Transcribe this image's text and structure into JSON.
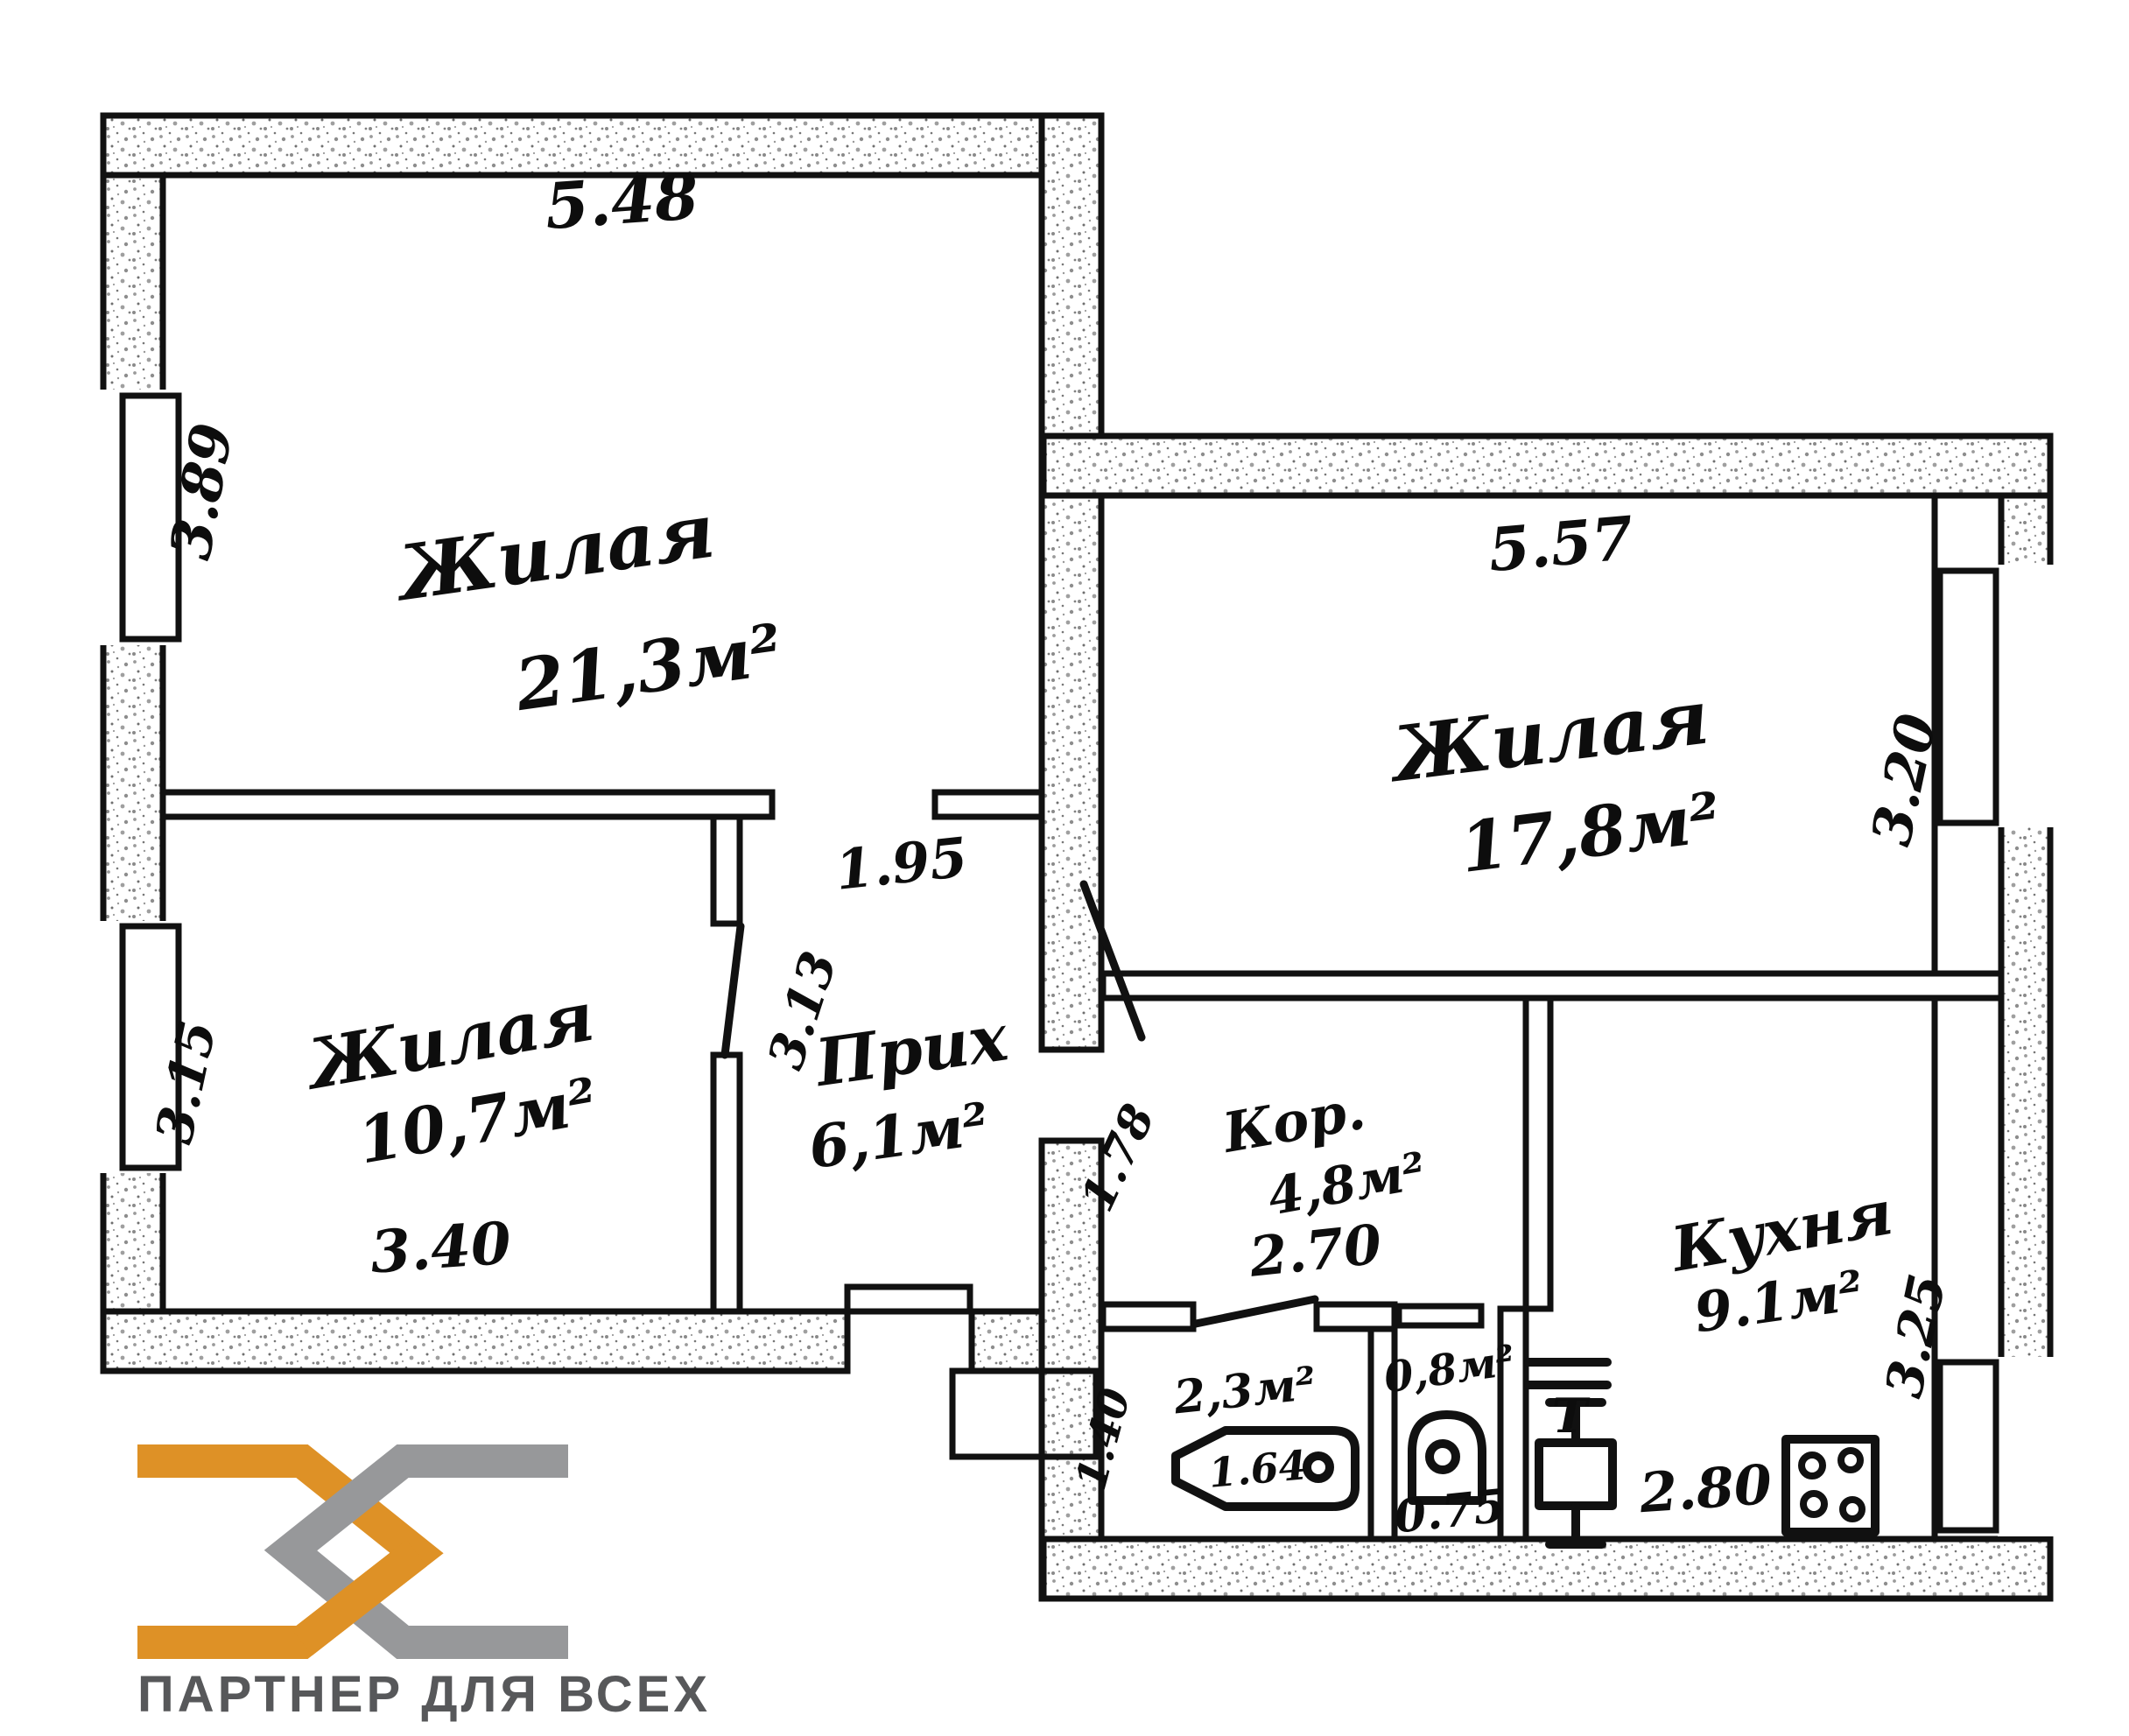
{
  "branding": {
    "slogan": "ПАРТНЕР ДЛЯ ВСЕХ",
    "colors": {
      "orange": "#DE9126",
      "gray": "#97989A",
      "slogan_text": "#57585A"
    }
  },
  "rooms": {
    "living1": {
      "name": "Жилая",
      "area": "21,3м²"
    },
    "living2": {
      "name": "Жилая",
      "area": "10,7м²"
    },
    "living3": {
      "name": "Жилая",
      "area": "17,8м²"
    },
    "hallway": {
      "name": "Прих",
      "area": "6,1м²"
    },
    "corridor": {
      "name": "Кор.",
      "area": "4,8м²"
    },
    "kitchen": {
      "name": "Кухня",
      "area": "9.1м²"
    },
    "bathroom": {
      "area": "2,3м²",
      "tub_length": "1.64"
    },
    "toilet": {
      "area": "0,8м²"
    },
    "vent": {
      "label": "Т"
    }
  },
  "dimensions": {
    "living1_width": "5.48",
    "living1_depth": "3.89",
    "hall_width": "1.95",
    "hall_depth": "3.13",
    "living2_depth": "3.15",
    "living2_width": "3.40",
    "living3_width": "5.57",
    "living3_depth": "3.20",
    "corridor_width": "2.70",
    "corridor_depth": "1.78",
    "bathroom_depth": "1.40",
    "toilet_width": "0.75",
    "kitchen_width": "2.80",
    "kitchen_depth": "3.25"
  }
}
